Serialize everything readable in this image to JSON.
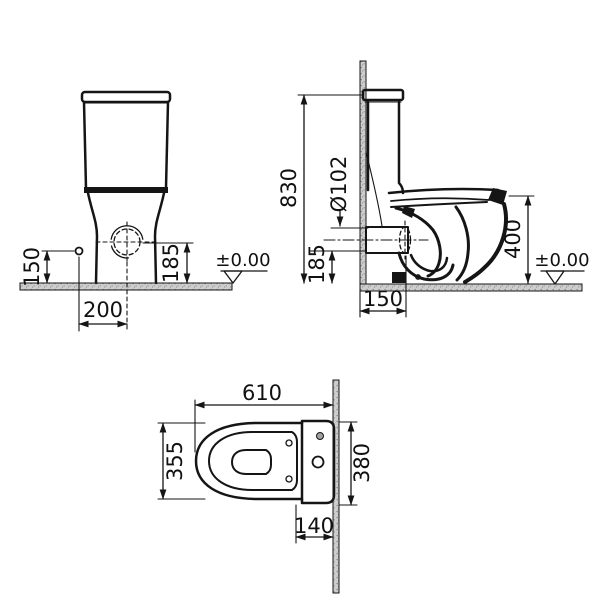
{
  "drawing_type": "toilet-technical-dimension-drawing",
  "colors": {
    "line": "#151515",
    "surface_fill": "#cdcdcd",
    "background": "#ffffff"
  },
  "dimensions": {
    "front_view": {
      "fixing_hole_height": "150",
      "outlet_center_height": "185",
      "fixing_hole_offset": "200",
      "floor_datum": "±0.00"
    },
    "side_view": {
      "overall_height": "830",
      "outlet_diameter": "Ø102",
      "outlet_center_height": "185",
      "bowl_rim_height": "400",
      "outlet_wall_distance": "150",
      "floor_datum": "±0.00"
    },
    "plan_view": {
      "overall_depth": "610",
      "bowl_width": "355",
      "tank_width": "380",
      "rear_fixing_offset": "140"
    }
  }
}
